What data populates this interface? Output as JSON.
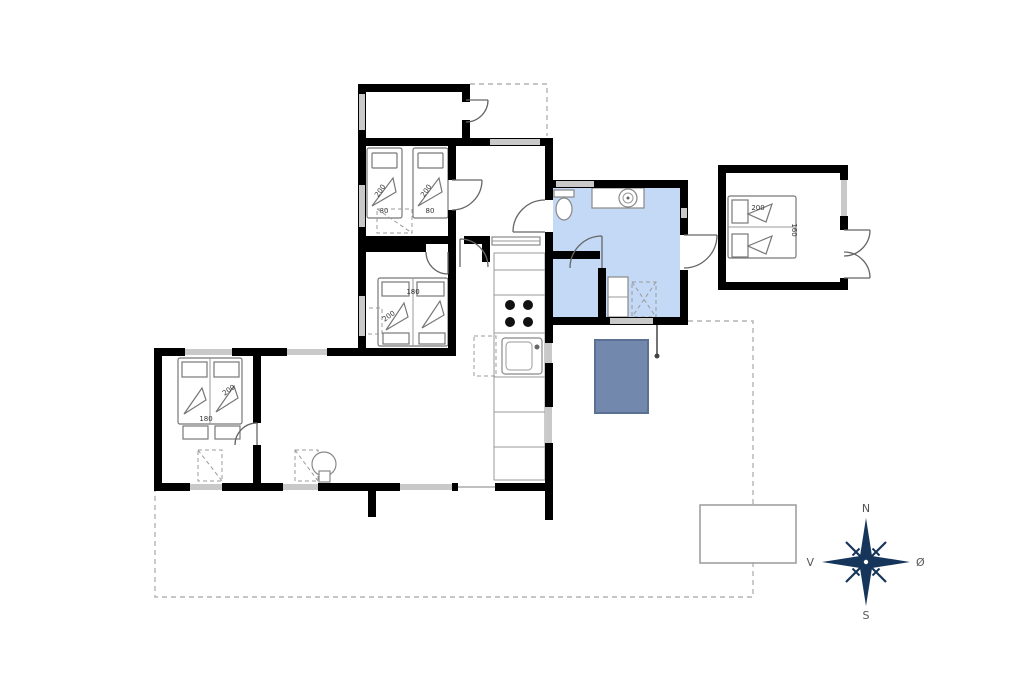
{
  "page": {
    "background": "#ffffff",
    "kind": "holiday-home-floor-plan"
  },
  "colors": {
    "wall": "#000000",
    "window": "#c9c9c9",
    "room_highlight": "#c3d9f6",
    "hot_tub": "#7288ac",
    "hot_tub_border": "#5c7093",
    "compass": "#16355a",
    "furniture_outline": "#777777",
    "dashed_outline": "#b3b3b3"
  },
  "beds": {
    "top_bedroom_bed1": {
      "length": "200",
      "width": "80"
    },
    "top_bedroom_bed2": {
      "length": "200",
      "width": "80"
    },
    "middle_bedroom_bed": {
      "length": "200",
      "width": "180"
    },
    "left_bedroom_bed": {
      "length": "200",
      "width": "180"
    },
    "annex_bed": {
      "length": "200",
      "width": "160"
    }
  },
  "compass": {
    "north": "N",
    "south": "S",
    "east": "Ø",
    "west": "V"
  }
}
